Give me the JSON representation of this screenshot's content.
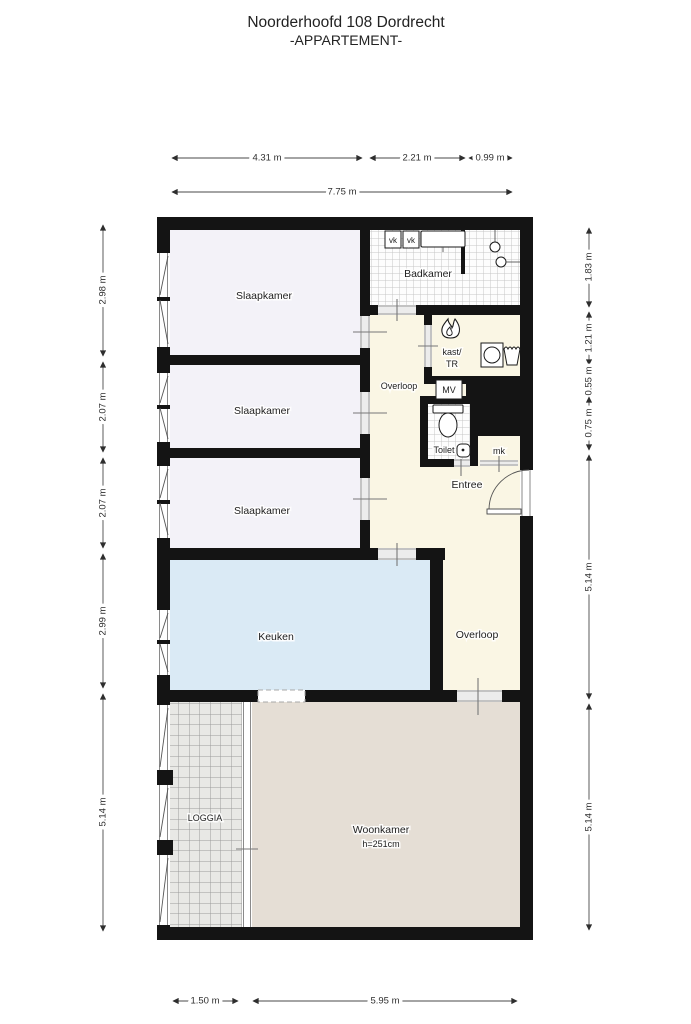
{
  "title": {
    "line1": "Noorderhoofd 108 Dordrecht",
    "line2": "-APPARTEMENT-"
  },
  "dimensions": {
    "top": [
      "4.31 m",
      "2.21 m",
      "0.99 m"
    ],
    "top_total": "7.75 m",
    "left": [
      "2.98 m",
      "2.07 m",
      "2.07 m",
      "2.99 m",
      "5.14 m"
    ],
    "right": [
      "1.83 m",
      "1.21 m",
      "0.55 m",
      "0.75 m",
      "5.14 m",
      "5.14 m"
    ],
    "bottom": [
      "1.50 m",
      "5.95 m"
    ]
  },
  "rooms": {
    "slaapkamer1": "Slaapkamer",
    "slaapkamer2": "Slaapkamer",
    "slaapkamer3": "Slaapkamer",
    "badkamer": "Badkamer",
    "overloop_top": "Overloop",
    "kast_line1": "kast/",
    "kast_line2": "TR",
    "toilet": "Toilet",
    "entree": "Entree",
    "overloop_bottom": "Overloop",
    "keuken": "Keuken",
    "loggia": "LOGGIA",
    "woonkamer": "Woonkamer",
    "woonkamer_height": "h=251cm"
  },
  "fixtures": {
    "vk1": "vk",
    "vk2": "vk",
    "mv": "MV",
    "mk": "mk"
  },
  "colors": {
    "wall": "#141414",
    "slaapkamer_fill": "#f3f2f8",
    "hall_fill": "#faf6e4",
    "keuken_fill": "#daeaf5",
    "woonkamer_fill": "#e5ded5",
    "loggia_fill": "#e8e8e5",
    "tile_line": "#c6c6c6",
    "dimension_line": "#4a4a4a"
  }
}
